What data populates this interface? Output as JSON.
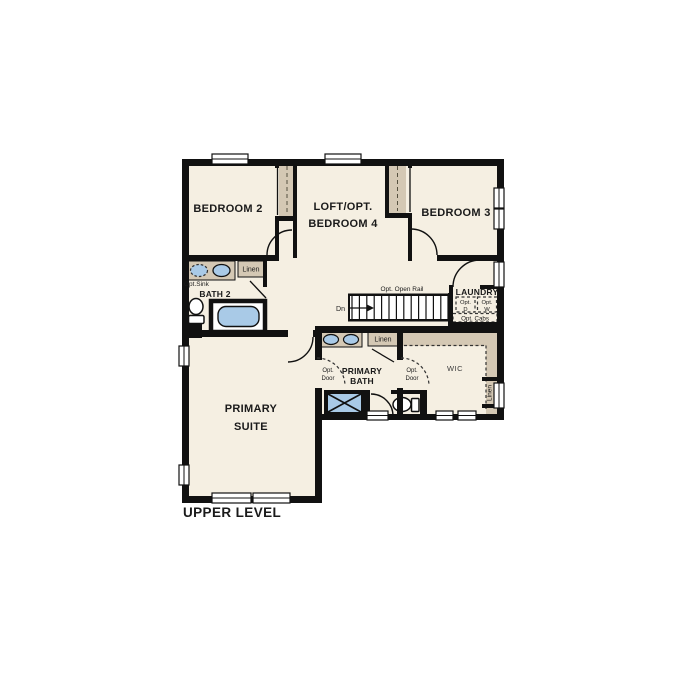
{
  "title": "UPPER LEVEL",
  "rooms": {
    "bedroom2": {
      "label": "BEDROOM 2"
    },
    "loft": {
      "line1": "LOFT/OPT.",
      "line2": "BEDROOM 4"
    },
    "bedroom3": {
      "label": "BEDROOM 3"
    },
    "bath2": {
      "label": "BATH 2"
    },
    "primary_bath": {
      "line1": "PRIMARY",
      "line2": "BATH"
    },
    "primary_suite": {
      "line1": "PRIMARY",
      "line2": "SUITE"
    },
    "laundry": {
      "label": "LAUNDRY"
    },
    "wic": {
      "label": "WIC"
    }
  },
  "annotations": {
    "opt_sink": "Opt.Sink",
    "linen": "Linen",
    "opt_open_rail": "Opt. Open Rail",
    "stairs_down": "Dn",
    "opt_prefix": "Opt.",
    "dryer": "D",
    "washer": "W",
    "opt_cabs": "Opt. Cabs",
    "opt_door_line1": "Opt.",
    "opt_door_line2": "Door"
  },
  "colors": {
    "wall": "#111111",
    "floor": "#f5efe2",
    "cabinet_tan": "#d4c8b4",
    "fixture_blue": "#a9cae7",
    "appliance_box": "#e2e6df",
    "background": "#ffffff"
  }
}
